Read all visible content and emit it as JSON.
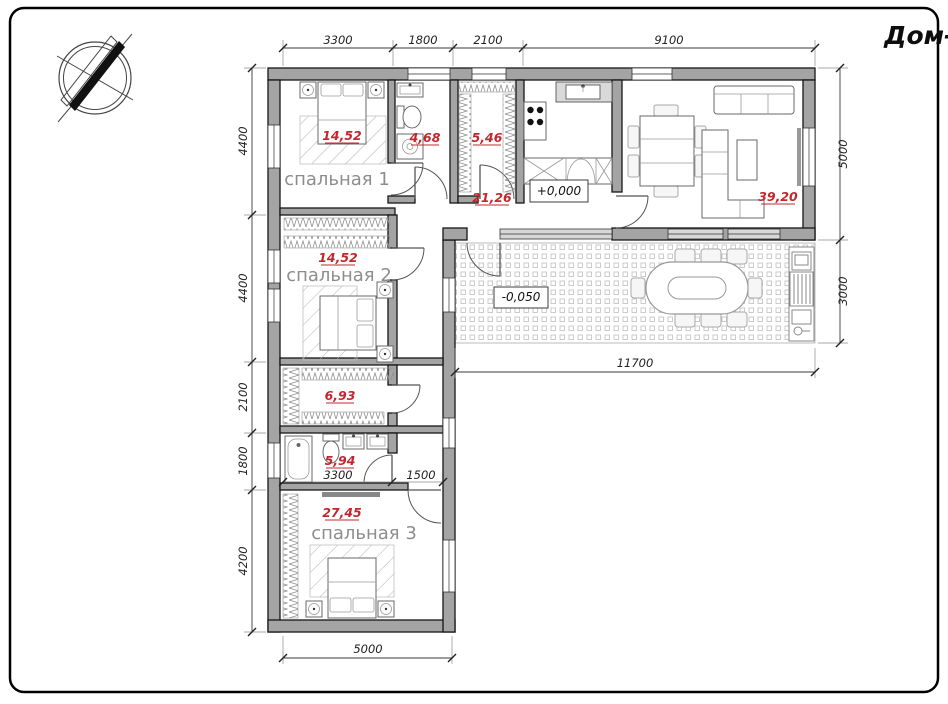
{
  "title": "Дом-1",
  "rooms": {
    "bedroom1": {
      "name": "спальная 1",
      "area": "14,52"
    },
    "bedroom2": {
      "name": "спальная 2",
      "area": "14,52"
    },
    "bedroom3": {
      "name": "спальная 3",
      "area": "27,45"
    },
    "bathroom_top": {
      "area": "4,68"
    },
    "wardrobe_top": {
      "area": "5,46"
    },
    "hall": {
      "area": "21,26"
    },
    "living": {
      "area": "39,20"
    },
    "closet": {
      "area": "6,93"
    },
    "bathroom_bottom": {
      "area": "5,94"
    }
  },
  "elevations": {
    "ground_floor": "+0,000",
    "terrace": "-0,050"
  },
  "dimensions": {
    "top": [
      "3300",
      "1800",
      "2100",
      "9100"
    ],
    "left": [
      "4400",
      "4400",
      "2100",
      "1800",
      "4200"
    ],
    "right": [
      "5000",
      "3000"
    ],
    "terrace_width": "11700",
    "bottom": "5000",
    "bathroom_width": "3300",
    "corridor_width": "1500"
  }
}
